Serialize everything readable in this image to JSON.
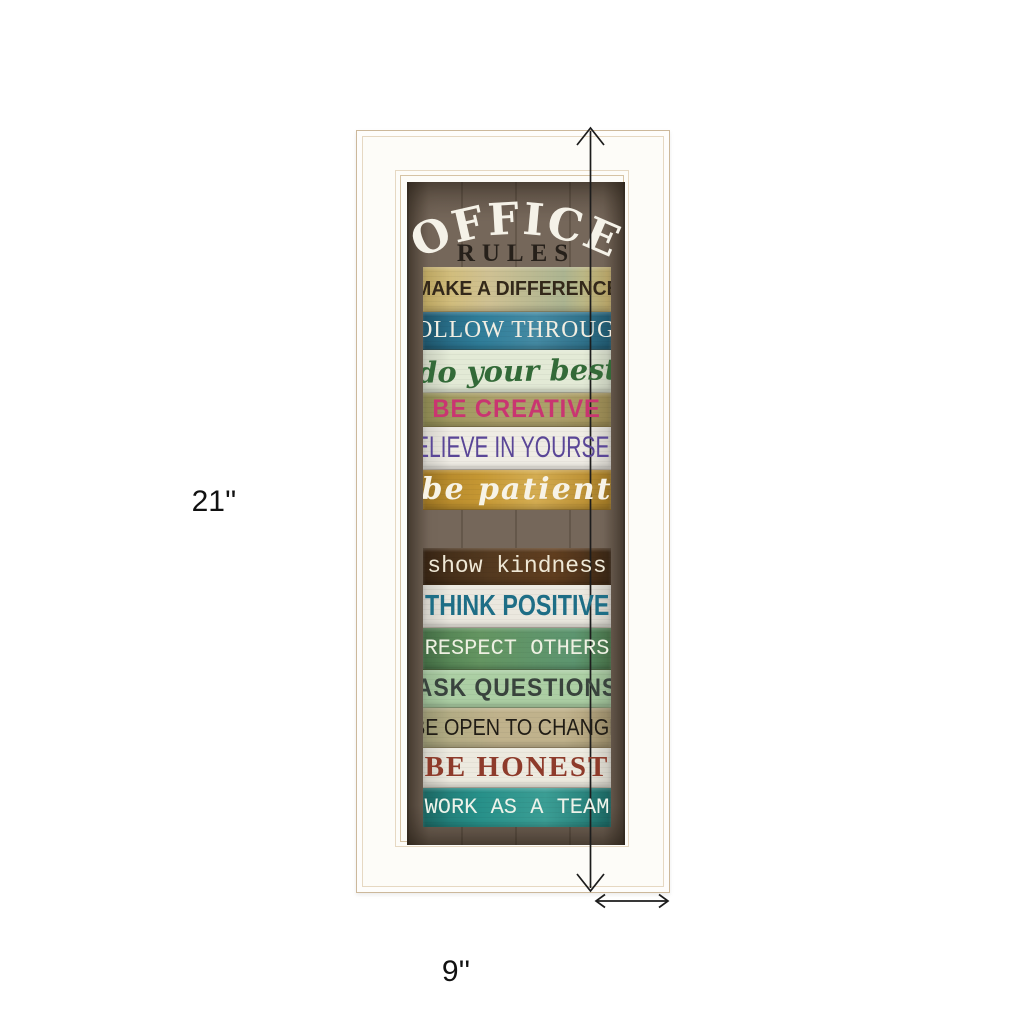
{
  "page": {
    "background": "#ffffff"
  },
  "dimensions": {
    "height_label": "21''",
    "width_label": "9''",
    "arrow_color": "#1c1c1c"
  },
  "frame": {
    "surface_color": "#fdfcf8",
    "line_color": "#d6c3a4"
  },
  "artwork": {
    "title_line1": "OFFICE",
    "title_line2": "RULES",
    "title_line1_color": "#f5f2e8",
    "title_line2_color": "#26201a",
    "wood_background": "#75675a",
    "slats": [
      {
        "text": "MAKE A DIFFERENCE",
        "bg": "#cfc193",
        "color": "#33281a"
      },
      {
        "text": "FOLLOW THROUGH",
        "bg": "#2f7d99",
        "color": "#f2eee2"
      },
      {
        "text": "do your best",
        "bg": "#e3ead6",
        "color": "#336a38"
      },
      {
        "text": "BE CREATIVE",
        "bg": "#aca06a",
        "color": "#c93571"
      },
      {
        "text": "BELIEVE IN YOURSELF",
        "bg": "#efece4",
        "color": "#5a4697"
      },
      {
        "text": "be patient",
        "bg": "#c59733",
        "color": "#f7f3e7"
      },
      {
        "text": "show kindness",
        "bg": "#53391f",
        "color": "#efe8d6"
      },
      {
        "text": "THINK POSITIVE",
        "bg": "#ebe8df",
        "color": "#1e6e86"
      },
      {
        "text": "RESPECT OTHERS",
        "bg": "#649561",
        "color": "#eef0e2"
      },
      {
        "text": "ASK QUESTIONS",
        "bg": "#accfa4",
        "color": "#39433d"
      },
      {
        "text": "BE OPEN TO CHANGE",
        "bg": "#c0b28c",
        "color": "#201c15"
      },
      {
        "text": "BE HONEST",
        "bg": "#edeadf",
        "color": "#8e3b2b"
      },
      {
        "text": "WORK AS A TEAM",
        "bg": "#279089",
        "color": "#edf2e9"
      }
    ]
  }
}
